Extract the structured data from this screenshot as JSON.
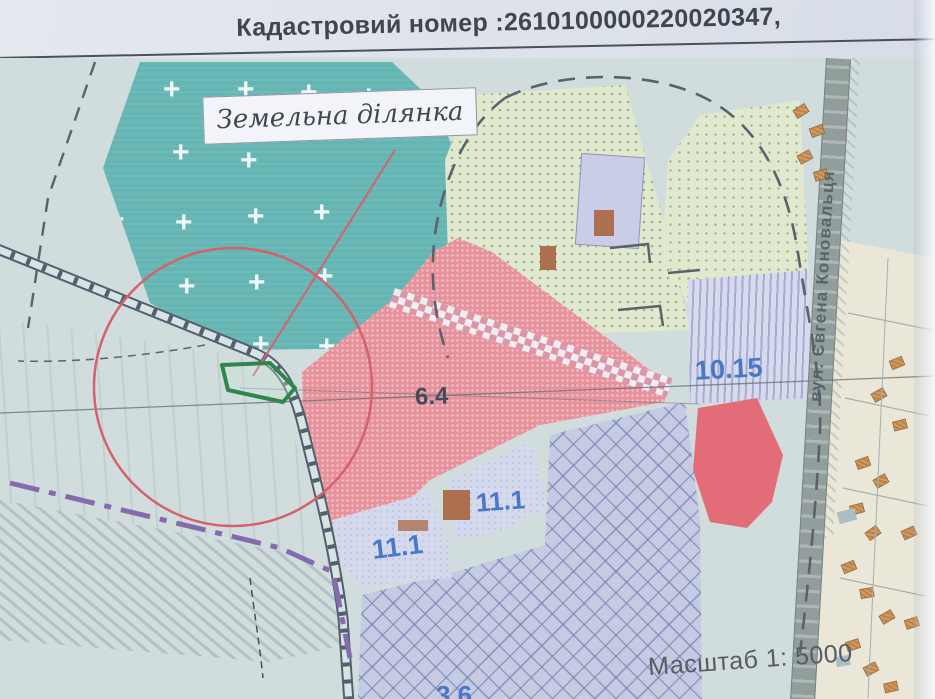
{
  "doc": {
    "title": "Кадастровий номер :2610100000220020347,",
    "scale": "Масштаб 1: 5000"
  },
  "map": {
    "plot_label": "Земельна ділянка",
    "street": "вул. Євгена Коновальця",
    "cross_glyph": "+",
    "areas": {
      "center": "6.4",
      "northeast": "10.15",
      "parcel_left": "11.1",
      "parcel_right": "11.1",
      "bottom": "3.6"
    },
    "colors": {
      "cemetery_teal": "#58b2ad",
      "zone_pink": "#ea8a92",
      "plot_red": "#e6606c",
      "lattice_blue": "#c5cae3",
      "boundary_purple": "#7d5fa8",
      "highlight_red": "#d6545e",
      "plot_green": "#1f7c3c",
      "area_number_blue": "#3b6dc2"
    }
  }
}
